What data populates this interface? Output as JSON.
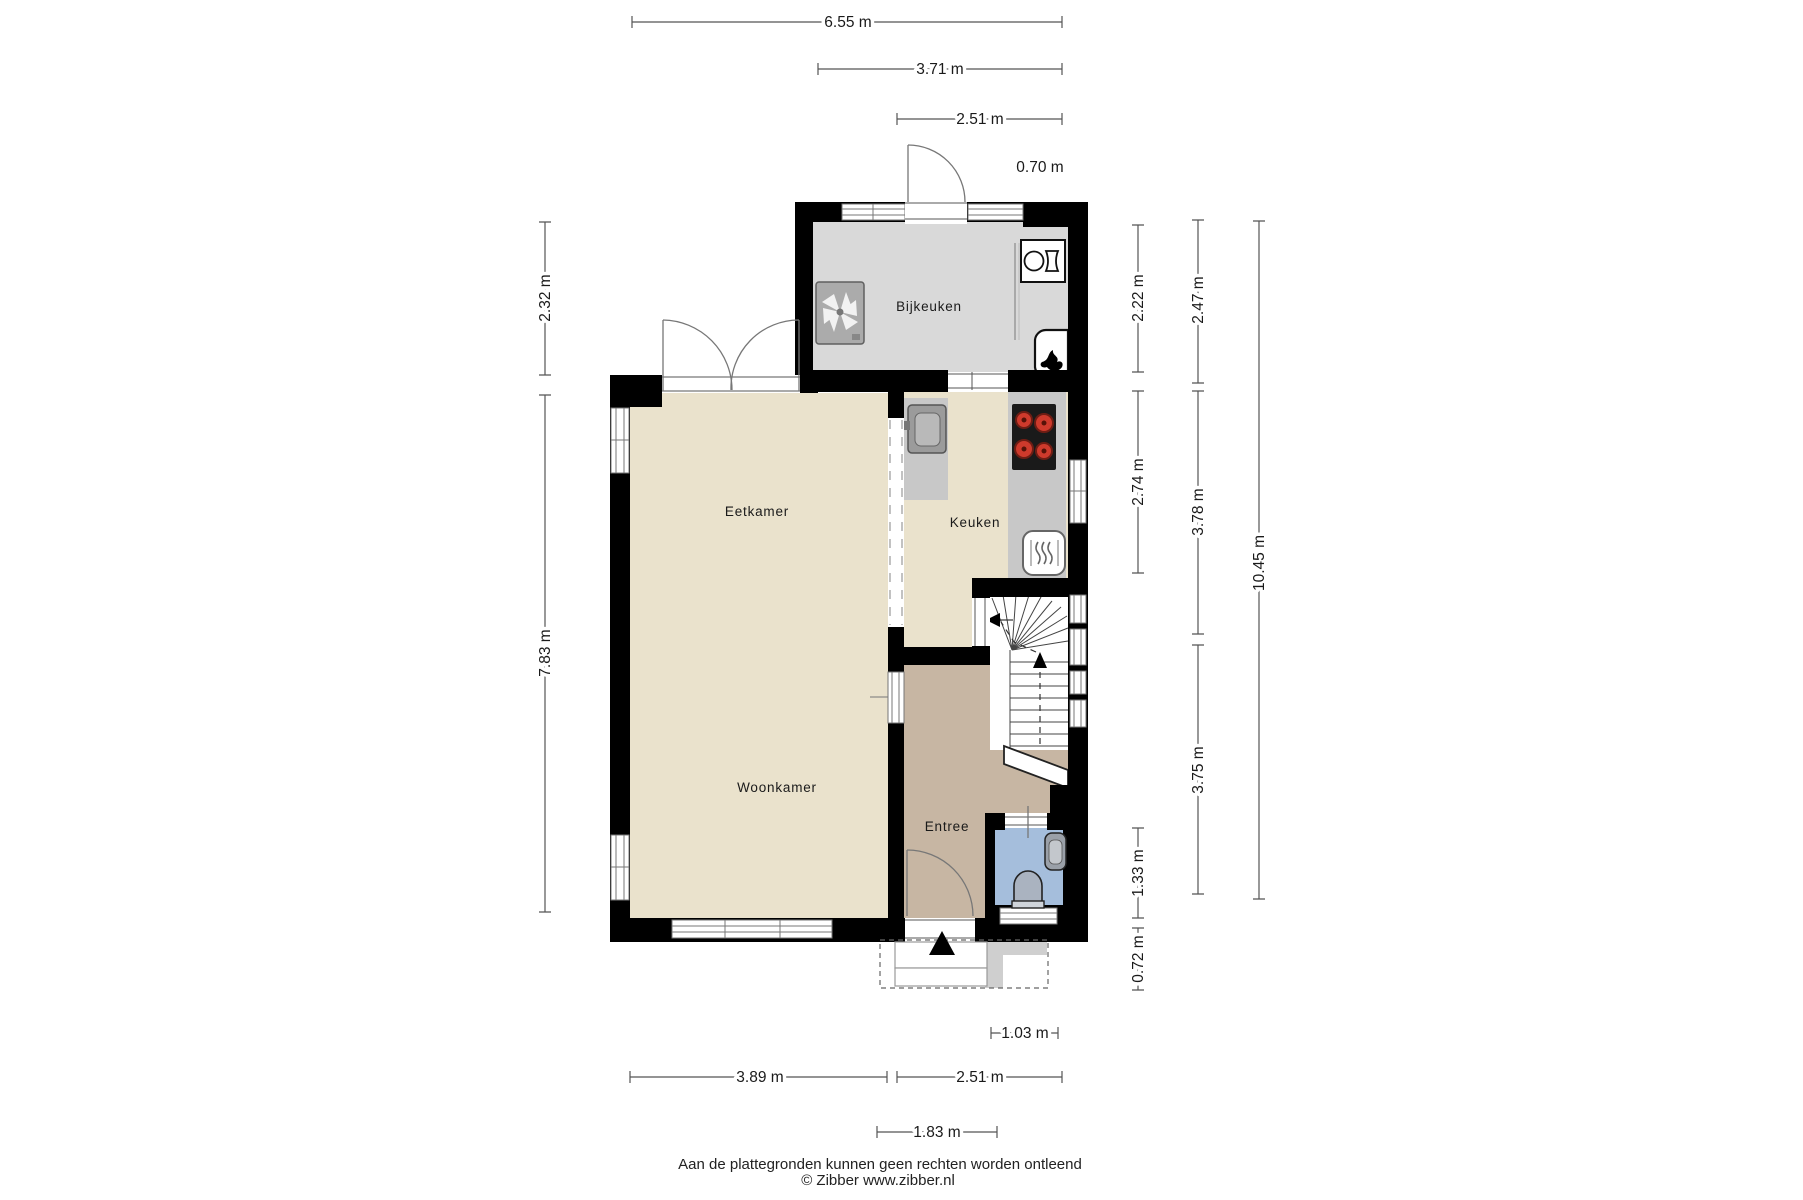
{
  "rooms": {
    "bijkeuken": {
      "label": "Bijkeuken"
    },
    "eetkamer": {
      "label": "Eetkamer"
    },
    "keuken": {
      "label": "Keuken"
    },
    "woonkamer": {
      "label": "Woonkamer"
    },
    "entree": {
      "label": "Entree"
    }
  },
  "dims": {
    "top": [
      {
        "label": "6.55 m"
      },
      {
        "label": "3.71 m"
      },
      {
        "label": "2.51 m"
      },
      {
        "label": "0.70 m"
      }
    ],
    "left": [
      {
        "label": "2.32 m"
      },
      {
        "label": "7.83 m"
      }
    ],
    "right_inner": [
      {
        "label": "2.22 m"
      },
      {
        "label": "2.74 m"
      },
      {
        "label": "1.33 m"
      },
      {
        "label": "0.72 m"
      }
    ],
    "right_mid": [
      {
        "label": "2.47 m"
      },
      {
        "label": "3.78 m"
      },
      {
        "label": "3.75 m"
      }
    ],
    "right_outer": [
      {
        "label": "10.45 m"
      }
    ],
    "bottom": [
      {
        "label": "3.89 m"
      },
      {
        "label": "2.51 m"
      },
      {
        "label": "1.83 m"
      },
      {
        "label": "1.03 m"
      }
    ]
  },
  "footer": {
    "disclaimer": "Aan de plattegronden kunnen geen rechten worden ontleend",
    "copyright": "© Zibber www.zibber.nl"
  },
  "colors": {
    "wall": "#000000",
    "floor_living": "#EAE2CC",
    "floor_utility": "#D9D9D9",
    "floor_hall": "#C7B6A3",
    "floor_toilet": "#A5BEDC",
    "counter": "#C8C8C8",
    "sink": "#9B9B9B",
    "stove": "#1A1A1A",
    "burner": "#CE3A2C",
    "appliance": "#ABABAB",
    "porch": "#CFCFCF"
  },
  "icons": {
    "names": [
      "fan-unit-icon",
      "washing-machine-icon",
      "boiler-icon",
      "kitchen-sink-icon",
      "stove-icon",
      "heater-icon",
      "basin-icon",
      "toilet-icon",
      "entry-arrow-icon",
      "stairs-up-arrow-icon",
      "stairs-exit-arrow-icon"
    ]
  }
}
